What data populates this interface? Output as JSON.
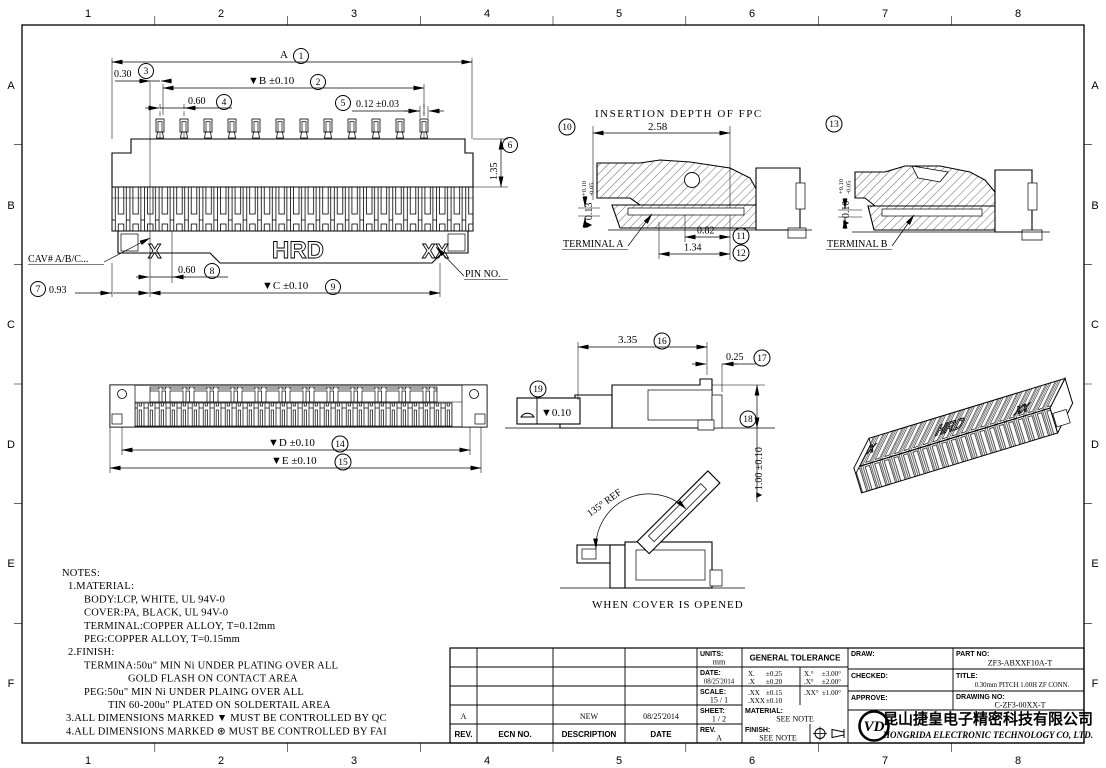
{
  "border": {
    "cols": [
      "1",
      "2",
      "3",
      "4",
      "5",
      "6",
      "7",
      "8"
    ],
    "rows": [
      "A",
      "B",
      "C",
      "D",
      "E",
      "F"
    ]
  },
  "top_view": {
    "dim_a": {
      "text": "A",
      "num": "1"
    },
    "dim_b": {
      "text": "▼B ±0.10",
      "num": "2"
    },
    "dim_030": {
      "text": "0.30",
      "num": "3"
    },
    "dim_060_top": {
      "text": "0.60",
      "num": "4"
    },
    "dim_012": {
      "text": "0.12 ±0.03",
      "num": "5"
    },
    "dim_135": {
      "text": "1.35",
      "num": "6"
    },
    "dim_093": {
      "text": "0.93",
      "num": "7"
    },
    "dim_060_bot": {
      "text": "0.60",
      "num": "8"
    },
    "dim_c": {
      "text": "▼C ±0.10",
      "num": "9"
    },
    "cav_label": "CAV# A/B/C...",
    "pin_label": "PIN NO.",
    "mark_x": "X",
    "mark_xx": "XX",
    "brand": "HRD"
  },
  "section_a": {
    "title": "INSERTION DEPTH OF FPC",
    "dim_258": "2.58",
    "dim_013": {
      "text": "▼0.13",
      "tol_up": "+0.10",
      "tol_dn": "-0.05",
      "num": "10"
    },
    "dim_082": {
      "text": "0.82",
      "num": "11"
    },
    "dim_134": {
      "text": "1.34",
      "num": "12"
    },
    "label": "TERMINAL A"
  },
  "section_b": {
    "dim_010": {
      "text": "▼0.10",
      "tol_up": "+0.10",
      "tol_dn": "-0.05",
      "num": "13"
    },
    "label": "TERMINAL B"
  },
  "bottom_view": {
    "dim_d": {
      "text": "▼D ±0.10",
      "num": "14"
    },
    "dim_e": {
      "text": "▼E ±0.10",
      "num": "15"
    }
  },
  "side_view": {
    "dim_335": {
      "text": "3.35",
      "num": "16"
    },
    "dim_025": {
      "text": "0.25",
      "num": "17"
    },
    "dim_100": {
      "text": "▼1.00 ±0.10",
      "num": "18"
    },
    "flatness": {
      "value": "▼0.10",
      "num": "19"
    }
  },
  "opened_view": {
    "angle": "135° REF",
    "caption": "WHEN COVER IS OPENED"
  },
  "notes": {
    "title": "NOTES:",
    "lines": [
      {
        "text": "1.MATERIAL:"
      },
      {
        "text": "BODY:LCP, WHITE, UL 94V-0"
      },
      {
        "text": "COVER:PA, BLACK, UL 94V-0"
      },
      {
        "text": "TERMINAL:COPPER ALLOY, T=0.12mm"
      },
      {
        "text": "PEG:COPPER ALLOY, T=0.15mm"
      },
      {
        "text": "2.FINISH:"
      },
      {
        "text": "TERMINA:50u\" MIN Ni UNDER PLATING OVER ALL"
      },
      {
        "text": "GOLD FLASH ON CONTACT AREA"
      },
      {
        "text": "PEG:50u\" MIN Ni UNDER PLAING OVER ALL"
      },
      {
        "text": "TIN 60-200u\" PLATED ON SOLDERTAIL AREA"
      },
      {
        "text": "3.ALL DIMENSIONS MARKED ▼ MUST BE CONTROLLED BY QC"
      },
      {
        "text": "4.ALL DIMENSIONS MARKED ⊛ MUST BE CONTROLLED BY FAI"
      }
    ]
  },
  "title_block": {
    "rev_table": {
      "headers": [
        "REV.",
        "ECN NO.",
        "DESCRIPTION",
        "DATE"
      ],
      "row": {
        "rev": "A",
        "ecn": "",
        "desc": "NEW",
        "date": "08/25'2014"
      }
    },
    "info": {
      "units_label": "UNITS:",
      "units": "mm",
      "date_label": "DATE:",
      "date": "08/25'2014",
      "scale_label": "SCALE:",
      "scale": "15 / 1",
      "sheet_label": "SHEET:",
      "sheet": "1 / 2",
      "rev_label": "REV.",
      "rev": "A"
    },
    "tolerance": {
      "title": "GENERAL TOLERANCE",
      "rows": [
        [
          "X.",
          "±0.25",
          "X.°",
          "±3.00°"
        ],
        [
          ".X",
          "±0.20",
          ".X°",
          "±2.00°"
        ],
        [
          ".XX",
          "±0.15",
          ".XX°",
          "±1.00°"
        ],
        [
          ".XXX",
          "±0.10",
          "",
          ""
        ]
      ]
    },
    "material_label": "MATERIAL:",
    "material": "SEE NOTE",
    "finish_label": "FINISH:",
    "finish": "SEE NOTE",
    "draw_label": "DRAW:",
    "checked_label": "CHECKED:",
    "approve_label": "APPROVE:",
    "part_label": "PART NO:",
    "part_no": "ZF3-ABXXF10A-T",
    "title_label": "TITLE:",
    "title": "0.30mm PITCH 1.00H ZF CONN.",
    "drawing_label": "DRAWING NO:",
    "drawing_no": "C-ZF3-00XX-T",
    "logo": "VD",
    "company_cn": "昆山捷皇电子精密科技有限公司",
    "company_en": "HONGRIDA ELECTRONIC TECHNOLOGY CO, LTD."
  }
}
